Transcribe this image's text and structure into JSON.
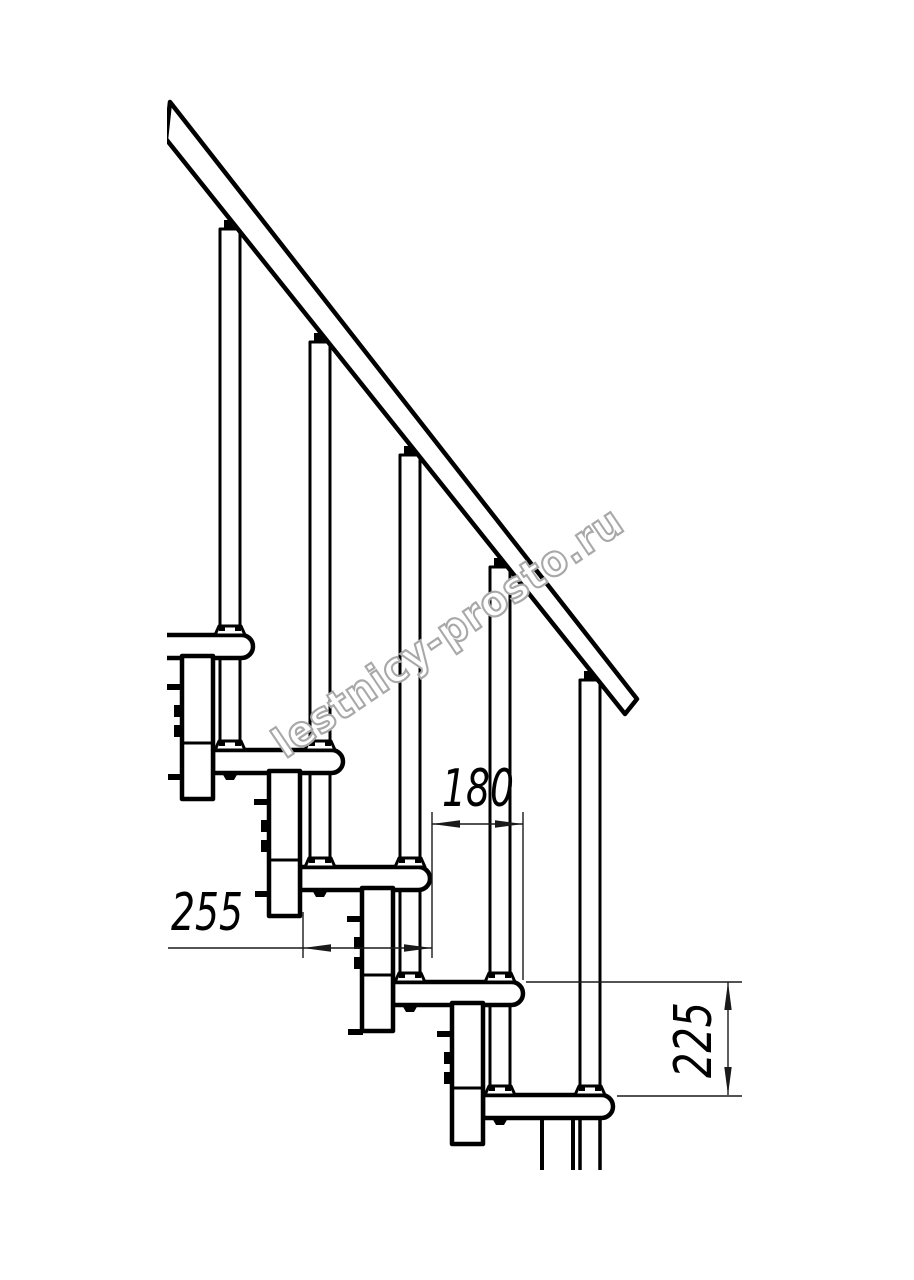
{
  "drawing": {
    "title": "Modular staircase side-view technical drawing",
    "watermark": "lestnicy-prosto.ru",
    "steps_visible": 5,
    "balusters_visible": 5,
    "colors": {
      "line": "#000000",
      "background": "#ffffff",
      "dimension_line": "#1a1a1a",
      "watermark_outline": "#a8a8a8"
    },
    "dimensions": {
      "tread_depth": {
        "label": "255"
      },
      "step_run": {
        "label": "180"
      },
      "riser_height": {
        "label": "225"
      }
    }
  }
}
